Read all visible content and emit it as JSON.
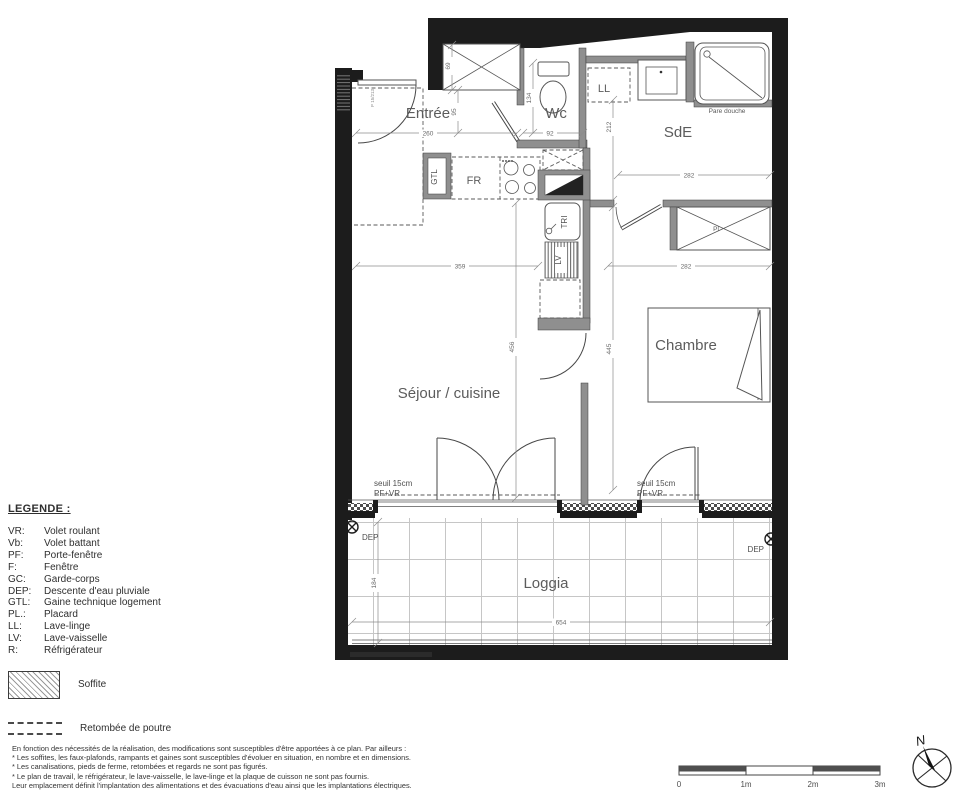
{
  "plan": {
    "rooms": {
      "entree": "Entrée",
      "wc": "Wc",
      "sde": "SdE",
      "sejour": "Séjour / cuisine",
      "chambre": "Chambre",
      "loggia": "Loggia"
    },
    "labels": {
      "ll": "LL",
      "gtl": "GTL",
      "fr": "FR",
      "tri": "TRI",
      "lv": "LV",
      "pl": "Pl",
      "pare_douche": "Pare douche",
      "seuil": "seuil 15cm",
      "pf_vr": "PF+VR",
      "dep": "DEP",
      "door_tag": "P 15/213"
    },
    "dimensions": {
      "d260": "260",
      "d92": "92",
      "d69": "69",
      "d95": "95",
      "d134": "134",
      "d212": "212",
      "d282_sde": "282",
      "d359": "359",
      "d282_ch": "282",
      "d456": "456",
      "d445": "445",
      "d654": "654",
      "d184": "184"
    }
  },
  "legend": {
    "title": "LEGENDE :",
    "items": [
      {
        "abbr": "VR:",
        "label": "Volet roulant"
      },
      {
        "abbr": "Vb:",
        "label": "Volet battant"
      },
      {
        "abbr": "PF:",
        "label": "Porte-fenêtre"
      },
      {
        "abbr": "F:",
        "label": "Fenêtre"
      },
      {
        "abbr": "GC:",
        "label": "Garde-corps"
      },
      {
        "abbr": "DEP:",
        "label": "Descente d'eau pluviale"
      },
      {
        "abbr": "GTL:",
        "label": "Gaine technique logement"
      },
      {
        "abbr": "PL.:",
        "label": "Placard"
      },
      {
        "abbr": "LL:",
        "label": "Lave-linge"
      },
      {
        "abbr": "LV:",
        "label": "Lave-vaisselle"
      },
      {
        "abbr": "R:",
        "label": "Réfrigérateur"
      }
    ],
    "soffite": "Soffite",
    "retombee": "Retombée de poutre"
  },
  "footnotes": [
    "En fonction des nécessités de la réalisation, des modifications sont susceptibles d'être apportées à ce plan. Par ailleurs :",
    "* Les soffites, les faux-plafonds, rampants et gaines sont susceptibles d'évoluer en situation, en nombre et en dimensions.",
    "* Les canalisations, pieds de ferme, retombées et regards ne sont pas figurés.",
    "* Le plan de travail, le réfrigérateur, le lave-vaisselle, le lave-linge et la plaque de cuisson ne sont pas fournis.",
    "Leur emplacement définit l'implantation des alimentations et des évacuations d'eau ainsi que les implantations électriques."
  ],
  "scalebar": {
    "t0": "0",
    "t1": "1m",
    "t2": "2m",
    "t3": "3m"
  },
  "compass": {
    "north": "N"
  },
  "colors": {
    "wall": "#1c1c1c",
    "partition": "#8f8f8f",
    "text": "#5c5c5c",
    "dim": "#6a6a6a"
  }
}
